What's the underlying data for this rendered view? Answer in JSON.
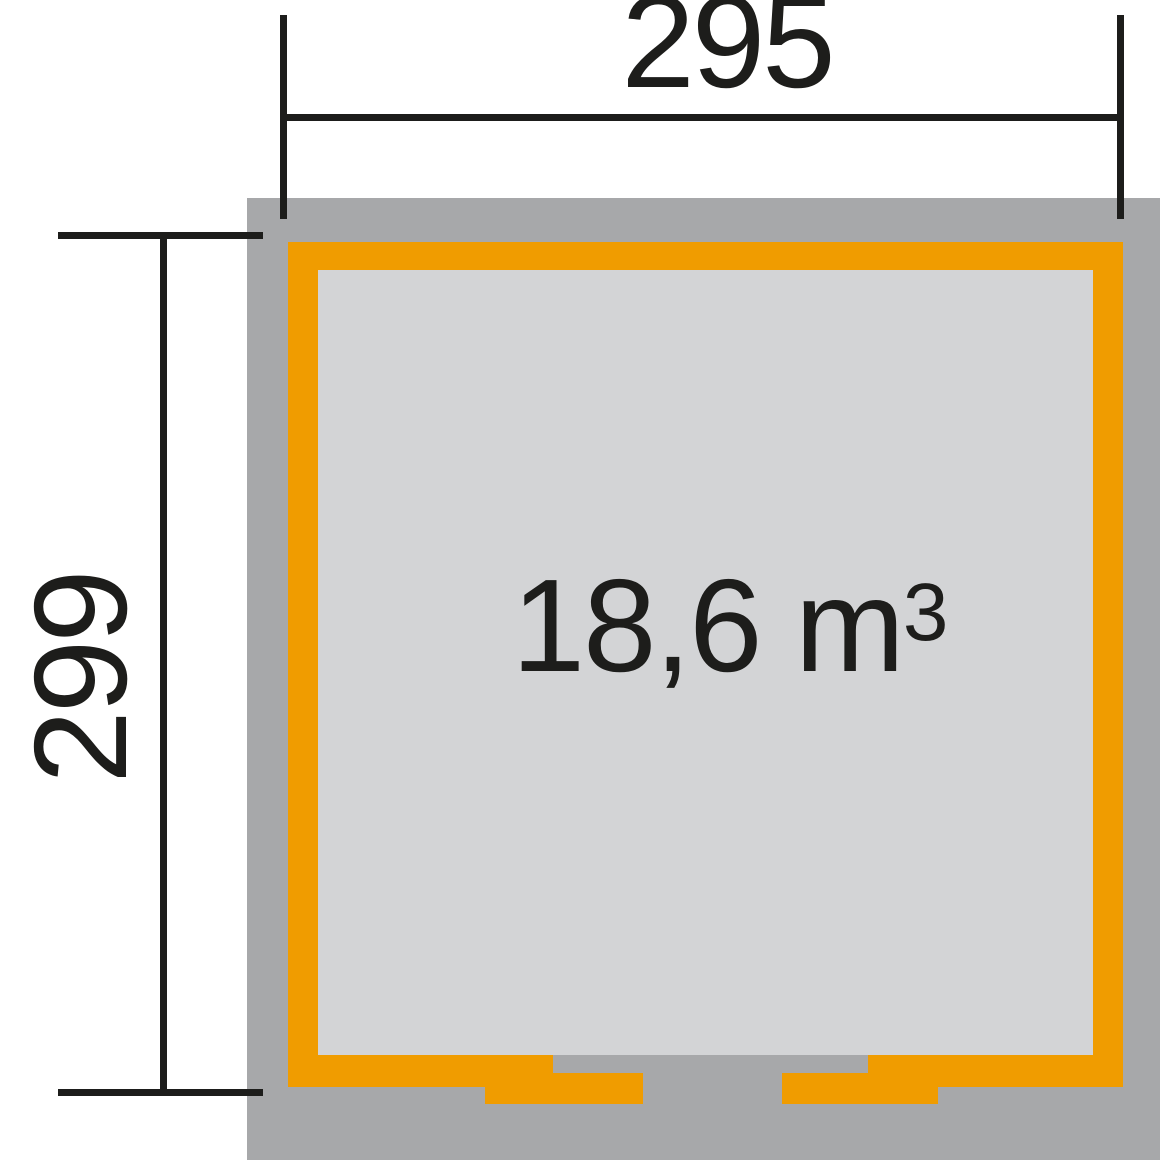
{
  "diagram": {
    "type": "floor-plan",
    "dimensions": {
      "width": "295",
      "depth": "299"
    },
    "volume": {
      "value": "18,6",
      "unit": "m",
      "exponent": "3"
    }
  },
  "colors": {
    "accent-orange": "#f09c00",
    "footprint-gray": "#a7a8aa",
    "floor-gray": "#d3d4d6",
    "line-black": "#1d1d1b",
    "background": "#ffffff"
  }
}
